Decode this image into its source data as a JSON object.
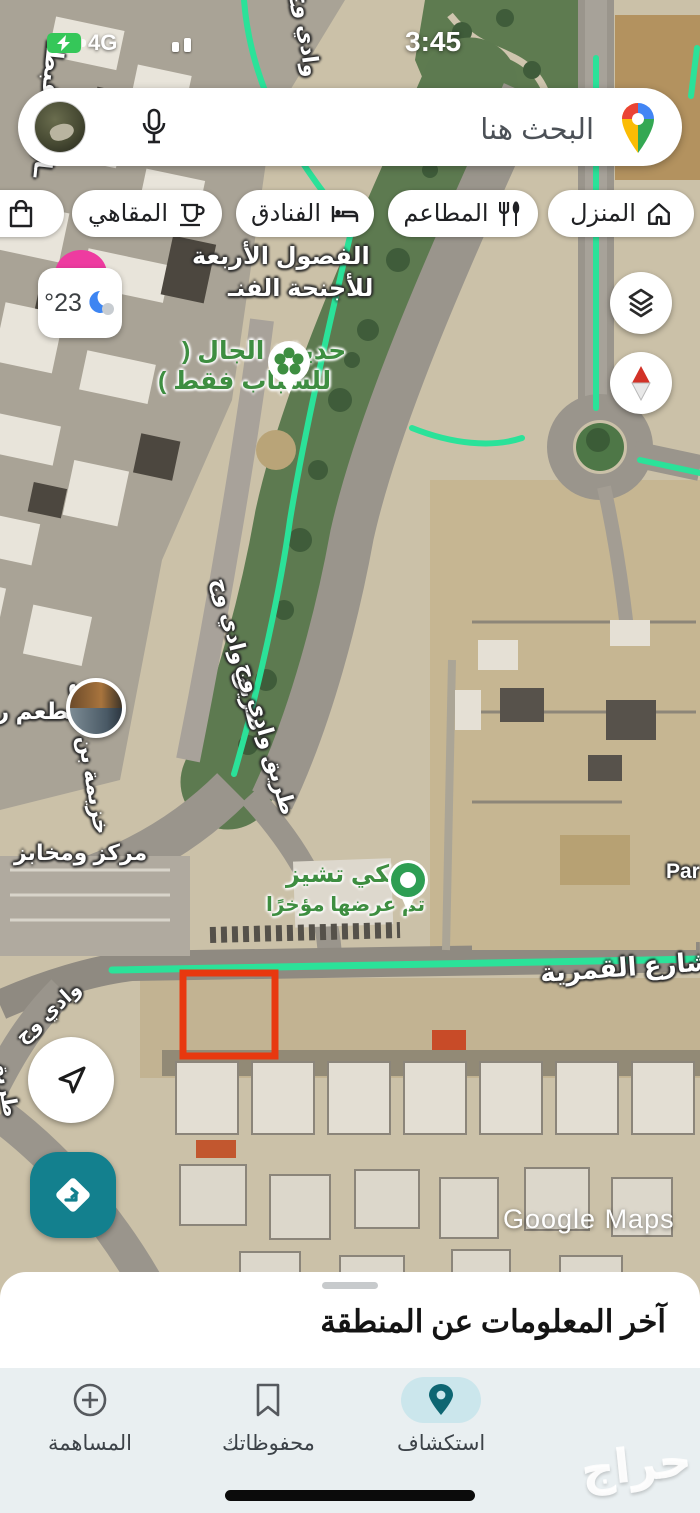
{
  "status_bar": {
    "network": "4G",
    "time": "3:45",
    "battery_icon": "battery-charging-icon",
    "signal_icon": "signal-bars-icon"
  },
  "search": {
    "placeholder": "البحث هنا",
    "mic_icon": "microphone-icon",
    "logo_icon": "google-maps-pin-logo",
    "avatar_icon": "account-avatar"
  },
  "chips": [
    {
      "label": "المنزل",
      "icon": "home-icon"
    },
    {
      "label": "المطاعم",
      "icon": "restaurants-icon"
    },
    {
      "label": "الفنادق",
      "icon": "hotels-icon"
    },
    {
      "label": "المقاهي",
      "icon": "cafes-icon"
    },
    {
      "label": "ال",
      "icon": "shopping-bag-icon"
    }
  ],
  "weather": {
    "temperature": "°23",
    "icon": "moon-cloud-icon"
  },
  "map_controls": {
    "layers_icon": "layers-icon",
    "compass_icon": "compass-icon",
    "my_location_icon": "my-location-arrow-icon",
    "directions_icon": "directions-icon"
  },
  "map": {
    "labels": {
      "street_top_left": "ـارية القبطـ",
      "four_seasons_1": "الفصول الأربعة",
      "four_seasons_2": "للأجنحة الفنـ",
      "park_1": "حديقة الجال (",
      "park_2": "للشباب فقط )",
      "wadi_wij_top": "وادي وج",
      "tariq_wadi_1": "طريق وادي وج",
      "tariq_wadi_2": "طريق وادي وج",
      "khuzayma": "خزيمة بن ثابت",
      "restaurant": "مطعم ر",
      "bakery_center": "مركز ومخابز",
      "chucke_1": "تشكي تشيز",
      "chucke_2": "تم عرضها مؤخرًا",
      "qamariya": "شارع القمرية",
      "par": "Par",
      "wadi_wij_small": "وادي وج",
      "left_edge_road": "طريق"
    },
    "colors": {
      "route_green": "#2be299",
      "highlight_red": "#e8380f",
      "poi_green": "#3e8e41",
      "accent_teal": "#13808e"
    }
  },
  "watermarks": {
    "google": "Google Maps",
    "haraj": "حراج"
  },
  "bottom_sheet": {
    "title": "آخر المعلومات عن المنطقة"
  },
  "bottom_nav": {
    "items": [
      {
        "label": "استكشاف",
        "icon": "explore-pin-icon",
        "active": true
      },
      {
        "label": "محفوظاتك",
        "icon": "bookmark-icon",
        "active": false
      },
      {
        "label": "المساهمة",
        "icon": "contribute-plus-icon",
        "active": false
      }
    ]
  }
}
